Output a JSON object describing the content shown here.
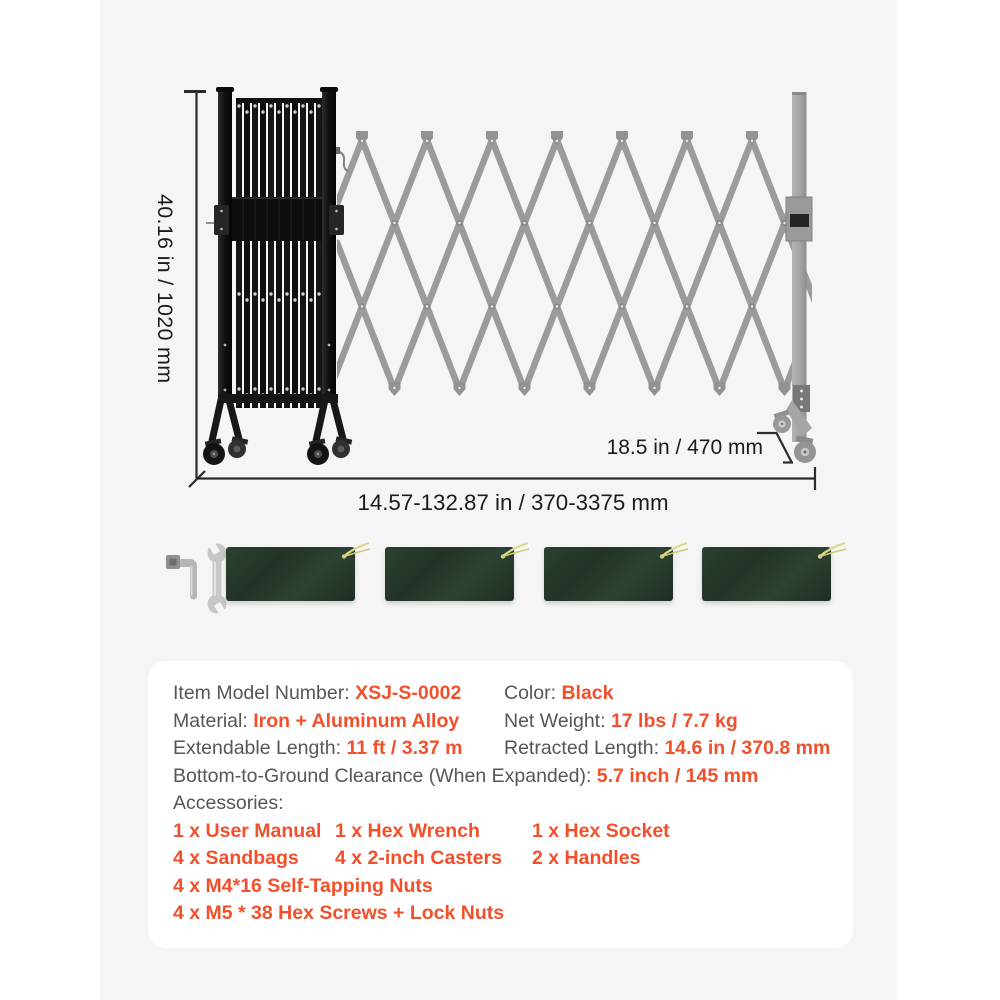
{
  "illustration": {
    "height_label": "40.16 in / 1020 mm",
    "depth_label": "18.5 in / 470 mm",
    "length_label": "14.57-132.87 in / 370-3375 mm"
  },
  "colors": {
    "accent_orange": "#f1502b",
    "label_gray": "#55555a",
    "dimension_text": "#1b1b1b",
    "stage_background": "#f5f5f6",
    "card_background": "#ffffff",
    "gate_black": "#151515",
    "lattice_gray": "#9b9b9b",
    "sandbag_green": "#253829",
    "drawstring_yellow": "#ddd78a"
  },
  "specs": {
    "item_model_label": "Item Model Number:",
    "item_model_value": "XSJ-S-0002",
    "color_label": "Color:",
    "color_value": "Black",
    "material_label": "Material:",
    "material_value": "Iron + Aluminum Alloy",
    "net_weight_label": "Net Weight:",
    "net_weight_value": "17 lbs / 7.7 kg",
    "extendable_label": "Extendable Length:",
    "extendable_value": "11 ft / 3.37 m",
    "retracted_label": "Retracted Length:",
    "retracted_value": "14.6 in / 370.8 mm",
    "clearance_label": "Bottom-to-Ground Clearance (When Expanded):",
    "clearance_value": "5.7 inch / 145 mm",
    "accessories_label": "Accessories:",
    "accessories": {
      "row1": [
        "1 x User Manual",
        "1 x Hex Wrench",
        "1 x Hex Socket"
      ],
      "row2": [
        "4 x Sandbags",
        "4 x 2-inch Casters",
        "2 x Handles"
      ],
      "row3": "4 x M4*16 Self-Tapping Nuts",
      "row4": "4 x M5 * 38 Hex Screws + Lock Nuts"
    }
  }
}
